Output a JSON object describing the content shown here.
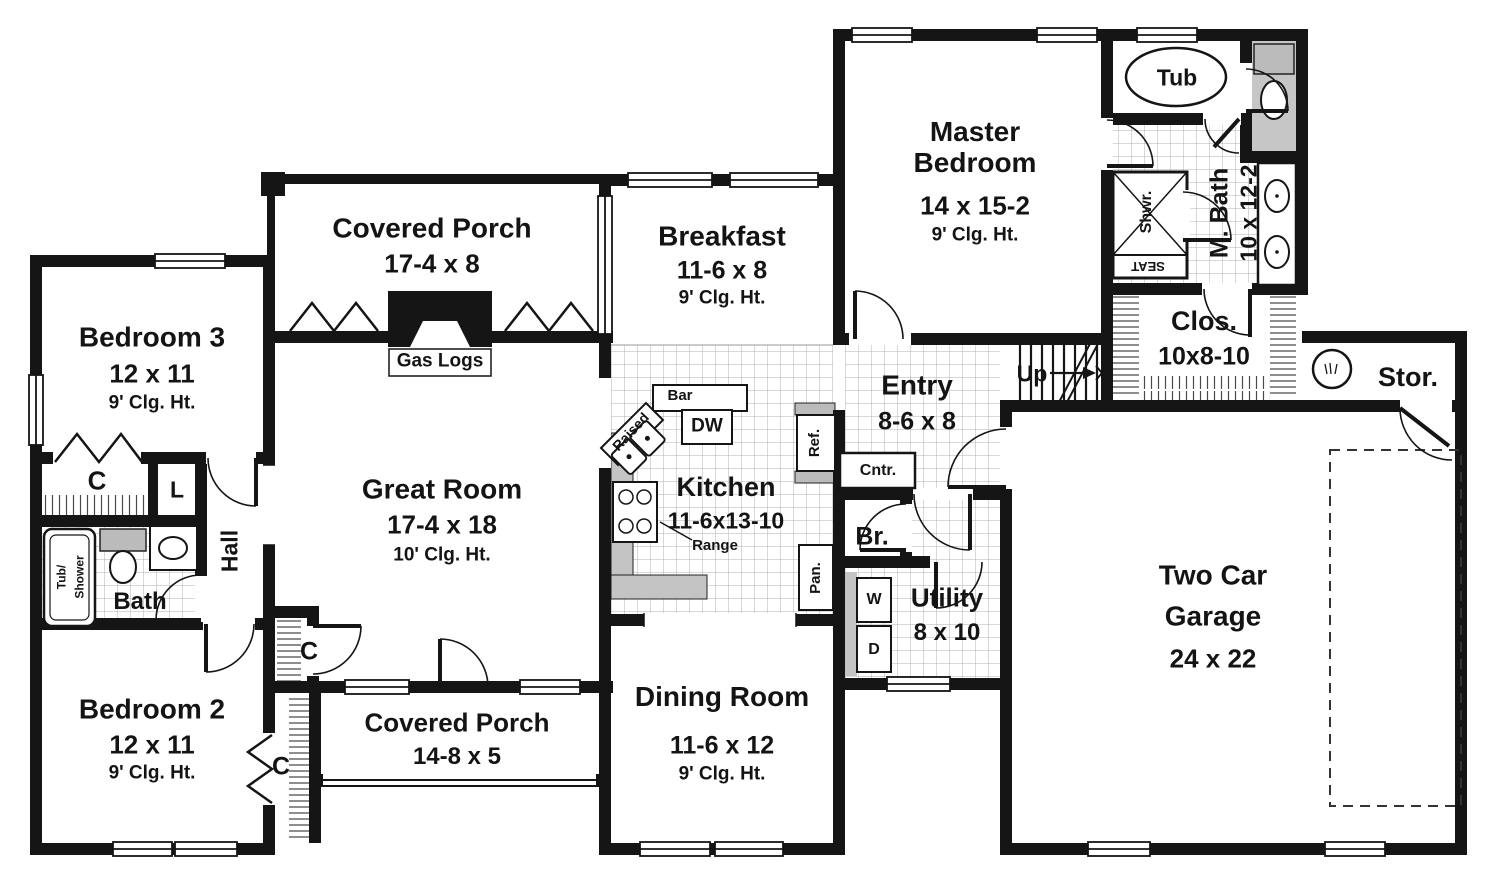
{
  "rooms": {
    "covered_porch_rear": {
      "name": "Covered Porch",
      "dim": "17-4 x 8"
    },
    "breakfast": {
      "name": "Breakfast",
      "dim": "11-6 x 8",
      "clg": "9' Clg. Ht."
    },
    "master_bedroom": {
      "name": "Master Bedroom",
      "dim": "14 x 15-2",
      "clg": "9' Clg. Ht."
    },
    "master_bath": {
      "name": "M. Bath",
      "dim": "10 x 12-2"
    },
    "closet_master": {
      "name": "Clos.",
      "dim": "10x8-10"
    },
    "storage": {
      "name": "Stor."
    },
    "entry": {
      "name": "Entry",
      "dim": "8-6 x 8"
    },
    "bath_half": {
      "name": "Br."
    },
    "utility": {
      "name": "Utility",
      "dim": "8 x 10"
    },
    "garage": {
      "name": "Two Car Garage",
      "dim": "24 x 22"
    },
    "kitchen": {
      "name": "Kitchen",
      "dim": "11-6x13-10"
    },
    "great_room": {
      "name": "Great Room",
      "dim": "17-4 x 18",
      "clg": "10' Clg. Ht."
    },
    "covered_porch_front": {
      "name": "Covered Porch",
      "dim": "14-8 x 5"
    },
    "dining_room": {
      "name": "Dining Room",
      "dim": "11-6 x 12",
      "clg": "9' Clg. Ht."
    },
    "bedroom2": {
      "name": "Bedroom 2",
      "dim": "12 x 11",
      "clg": "9' Clg. Ht."
    },
    "bedroom3": {
      "name": "Bedroom 3",
      "dim": "12 x 11",
      "clg": "9' Clg. Ht."
    },
    "bath": {
      "name": "Bath"
    },
    "hall": {
      "name": "Hall"
    }
  },
  "labels": {
    "up": "Up",
    "cntr": "Cntr.",
    "tub": "Tub",
    "shower": "Shwr.",
    "seat": "SEAT",
    "tub_shower_1": "Tub/",
    "tub_shower_2": "Shower",
    "gas_logs": "Gas Logs",
    "dw": "DW",
    "ref": "Ref.",
    "pan": "Pan.",
    "range": "Range",
    "raised": "Raised",
    "bar": "Bar",
    "washer": "W",
    "dryer": "D",
    "closet_c": "C",
    "linen": "L"
  }
}
